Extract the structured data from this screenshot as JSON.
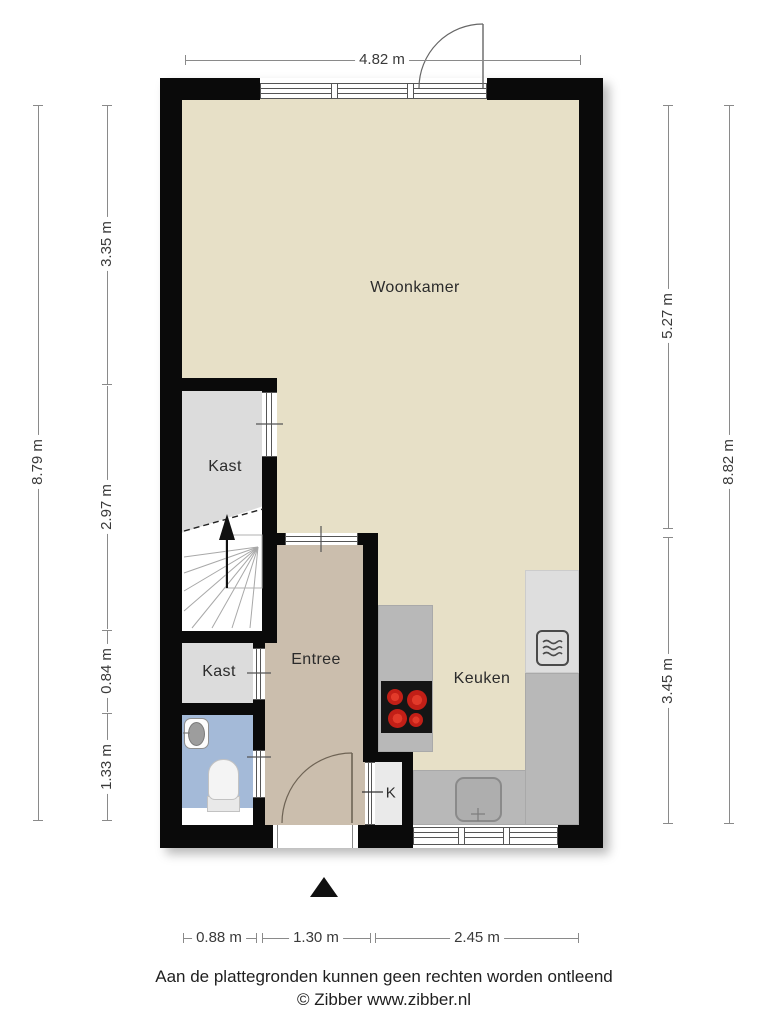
{
  "plan": {
    "rooms": {
      "woonkamer": "Woonkamer",
      "kast1": "Kast",
      "kast2": "Kast",
      "entree": "Entree",
      "keuken": "Keuken",
      "k_closet": "K"
    },
    "dimensions": {
      "top": "4.82 m",
      "left_outer": "8.79 m",
      "left_inner": [
        "3.35 m",
        "2.97 m",
        "0.84 m",
        "1.33 m"
      ],
      "right_inner": [
        "5.27 m",
        "3.45 m"
      ],
      "right_outer": "8.82 m",
      "bottom": [
        "0.88 m",
        "1.30 m",
        "2.45 m"
      ]
    },
    "icons": [
      "stairs-icon",
      "stairs-up-arrow-icon",
      "stove-icon",
      "microwave-icon",
      "kitchen-sink-icon",
      "washbasin-icon",
      "toilet-icon",
      "north-arrow-icon",
      "door-swing-icon",
      "window-icon"
    ],
    "colors": {
      "wall": "#0a0a0a",
      "floor_main": "#e7e0c7",
      "floor_entree": "#cbbead",
      "floor_closet": "#dcdcdc",
      "floor_bath": "#a4bad8",
      "counter": "#b8b8b8",
      "counter_light": "#dedede",
      "burner_red": "#c21f17",
      "background": "#ffffff"
    }
  },
  "footer": {
    "disclaimer": "Aan de plattegronden kunnen geen rechten worden ontleend",
    "credit": "© Zibber www.zibber.nl"
  }
}
